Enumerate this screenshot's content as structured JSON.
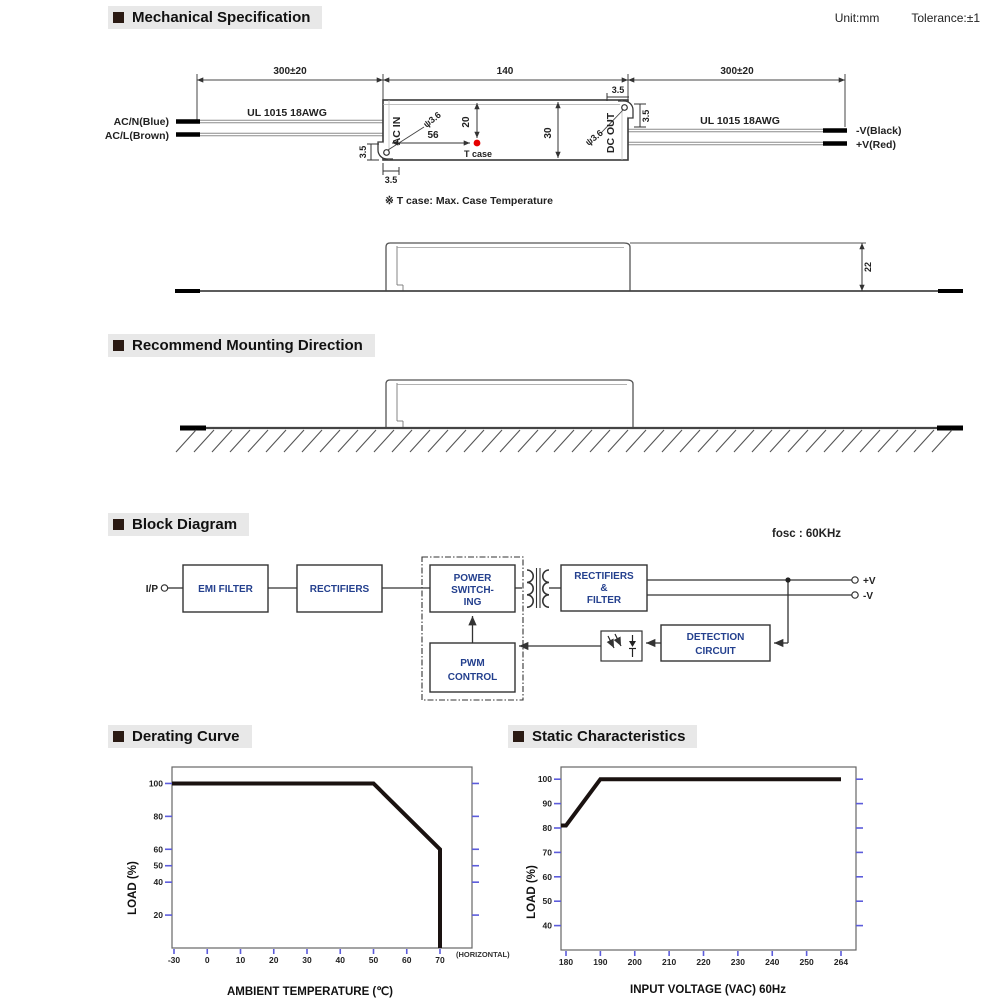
{
  "headers": {
    "mechanical": "Mechanical Specification",
    "mounting": "Recommend Mounting Direction",
    "block": "Block Diagram",
    "derating": "Derating Curve",
    "statics": "Static Characteristics",
    "unit_note": "Unit:mm",
    "tolerance_note": "Tolerance:±1",
    "fosc": "fosc : 60KHz",
    "tcase_note": "※ T case: Max. Case Temperature"
  },
  "colors": {
    "tick": "#5c5cdb",
    "curve": "#1a1210",
    "header_bg": "#e8e8e8",
    "bullet": "#2a1a13",
    "block_text": "#24408e",
    "tcase_dot": "#e60000"
  },
  "mech": {
    "dims": {
      "wire_len": "300±20",
      "case_len": "140",
      "hole": "ψ3.6",
      "d56": "56",
      "d20": "20",
      "d30": "30",
      "d22": "22",
      "d35": "3.5"
    },
    "labels": {
      "acn": "AC/N(Blue)",
      "acl": "AC/L(Brown)",
      "vminus": "-V(Black)",
      "vplus": "+V(Red)",
      "wire_type": "UL 1015 18AWG",
      "ac_in": "AC IN",
      "dc_out": "DC OUT",
      "tcase": "T case"
    }
  },
  "block": {
    "ip": "I/P",
    "emi": "EMI FILTER",
    "rectifiers": "RECTIFIERS",
    "power1": "POWER",
    "power2": "SWITCH-",
    "power3": "ING",
    "pwm1": "PWM",
    "pwm2": "CONTROL",
    "rf1": "RECTIFIERS",
    "rf2": "&",
    "rf3": "FILTER",
    "det1": "DETECTION",
    "det2": "CIRCUIT",
    "vplus": "+V",
    "vminus": "-V"
  },
  "chart_data": [
    {
      "type": "line",
      "title": "Derating Curve",
      "xlabel": "AMBIENT TEMPERATURE (℃)",
      "ylabel": "LOAD (%)",
      "xticks": [
        -30,
        0,
        10,
        20,
        30,
        40,
        50,
        60,
        70
      ],
      "x_annotation": "(HORIZONTAL)",
      "yticks": [
        20,
        40,
        50,
        60,
        80,
        100
      ],
      "ylim": [
        0,
        110
      ],
      "grid": false,
      "legend": null,
      "extend_left": true,
      "series": [
        {
          "name": "load_vs_ambient_temp",
          "points": [
            [
              -30,
              100
            ],
            [
              50,
              100
            ],
            [
              70,
              60
            ],
            [
              70,
              0
            ]
          ]
        }
      ]
    },
    {
      "type": "line",
      "title": "Static Characteristics",
      "xlabel": "INPUT VOLTAGE (VAC) 60Hz",
      "ylabel": "LOAD (%)",
      "xticks": [
        180,
        190,
        200,
        210,
        220,
        230,
        240,
        250,
        264
      ],
      "yticks": [
        40,
        50,
        60,
        70,
        80,
        90,
        100
      ],
      "ylim": [
        30,
        105
      ],
      "grid": false,
      "legend": null,
      "extend_left": true,
      "series": [
        {
          "name": "load_vs_input_voltage",
          "points": [
            [
              180,
              81
            ],
            [
              190,
              100
            ],
            [
              264,
              100
            ]
          ]
        }
      ]
    }
  ]
}
